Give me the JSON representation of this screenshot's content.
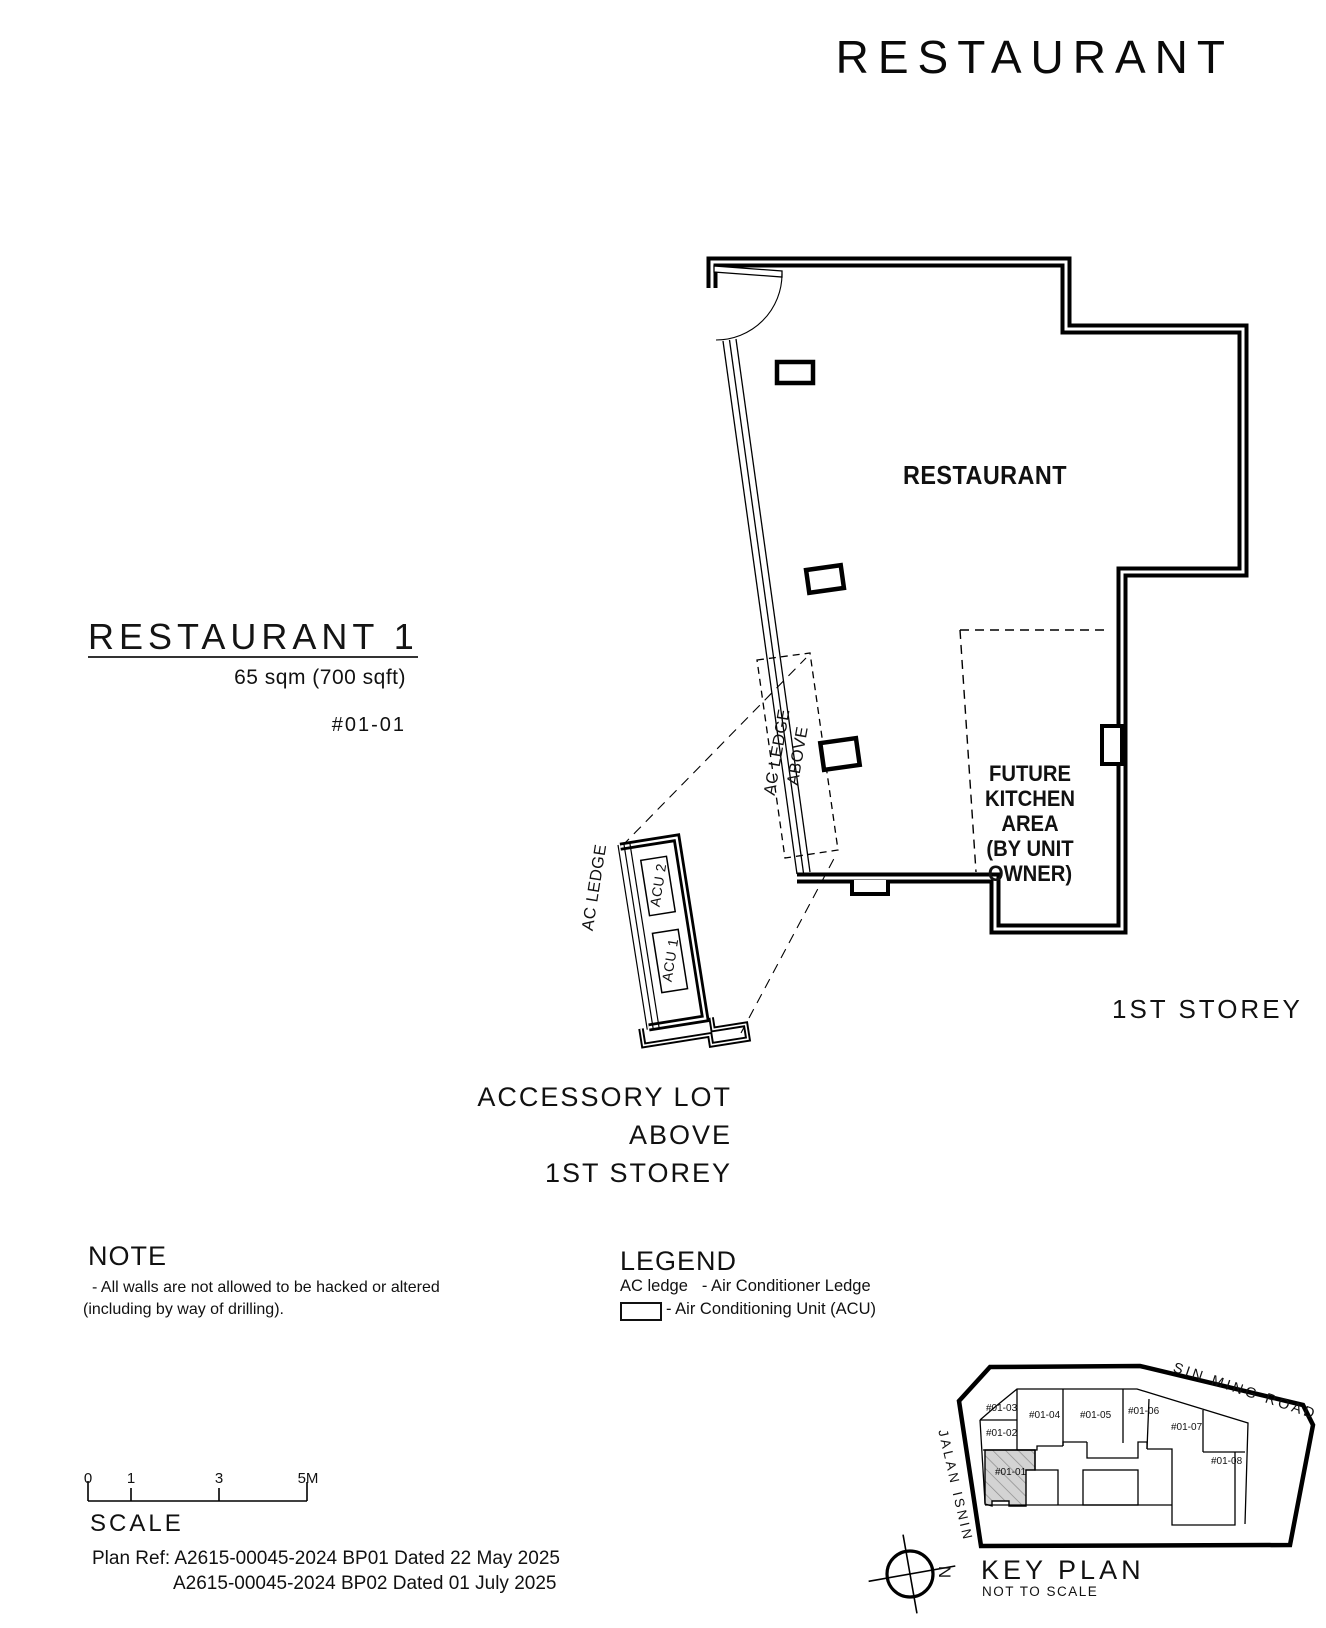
{
  "title": "RESTAURANT",
  "unit": {
    "name": "RESTAURANT 1",
    "area": "65 sqm (700 sqft)",
    "unit_no": "#01-01"
  },
  "plan": {
    "room_label": "RESTAURANT",
    "kitchen_lines": [
      "FUTURE",
      "KITCHEN AREA",
      "(BY UNIT",
      "OWNER)"
    ],
    "storey": "1ST STOREY",
    "ac_ledge_above_line1": "AC LEDGE",
    "ac_ledge_above_line2": "ABOVE",
    "ac_ledge": "AC LEDGE",
    "acu1": "ACU 1",
    "acu2": "ACU 2",
    "accessory_lines": [
      "ACCESSORY LOT",
      "ABOVE",
      "1ST STOREY"
    ]
  },
  "note": {
    "heading": "NOTE",
    "line1": "-  All walls are not allowed to be hacked or altered",
    "line2": "(including by way of drilling)."
  },
  "legend": {
    "heading": "LEGEND",
    "ac_ledge_label": "AC ledge",
    "ac_ledge_desc": "- Air Conditioner Ledge",
    "acu_desc": "- Air Conditioning Unit (ACU)"
  },
  "scale": {
    "heading": "SCALE",
    "ticks": [
      "0",
      "1",
      "3",
      "5M"
    ]
  },
  "plan_ref": {
    "line1": "Plan Ref: A2615-00045-2024 BP01 Dated 22 May 2025",
    "line2": "A2615-00045-2024 BP02 Dated 01 July 2025"
  },
  "key_plan": {
    "heading": "KEY PLAN",
    "subheading": "NOT TO SCALE",
    "north": "N",
    "roads": {
      "sin_ming": "SIN MING ROAD",
      "jalan_isnin": "JALAN ISNIN"
    },
    "units": [
      "#01-03",
      "#01-04",
      "#01-05",
      "#01-06",
      "#01-07",
      "#01-08",
      "#01-02",
      "#01-01"
    ],
    "highlighted_unit": "#01-01"
  },
  "colors": {
    "line": "#000000",
    "background": "#ffffff",
    "hatch_fill": "#d3d3d3",
    "hatch_line": "#8a8a8a"
  }
}
